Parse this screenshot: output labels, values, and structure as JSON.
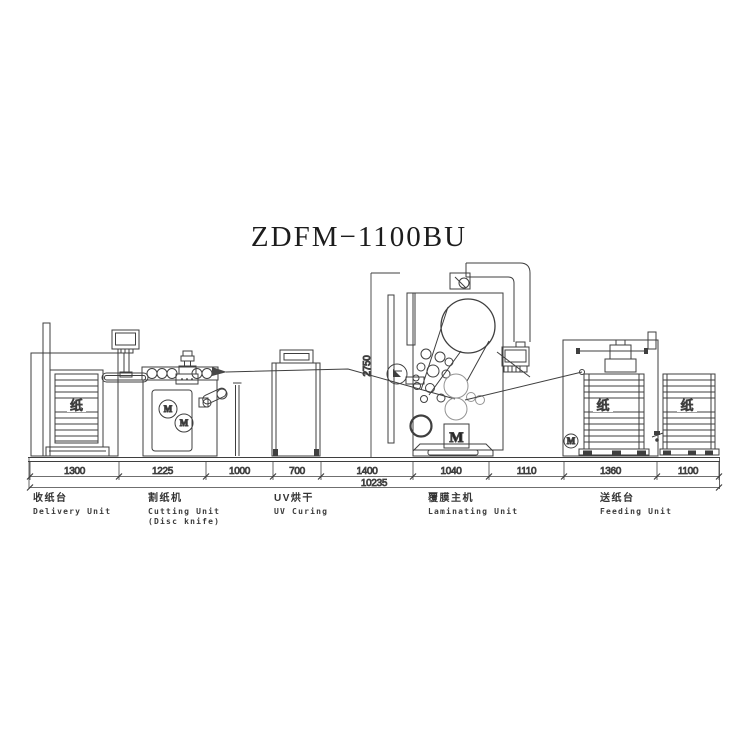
{
  "title": "ZDFM−1100BU",
  "dimensions": {
    "segments": [
      "1300",
      "1225",
      "1000",
      "700",
      "1400",
      "1040",
      "1110",
      "1360",
      "1100"
    ],
    "total": "10235",
    "machine_height": "2750"
  },
  "unit_labels": [
    {
      "zh": "收纸台",
      "en": "Delivery Unit",
      "en2": ""
    },
    {
      "zh": "割纸机",
      "en": "Cutting Unit",
      "en2": "(Disc knife)"
    },
    {
      "zh": "UV烘干",
      "en": "UV Curing",
      "en2": ""
    },
    {
      "zh": "覆膜主机",
      "en": "Laminating Unit",
      "en2": ""
    },
    {
      "zh": "送纸台",
      "en": "Feeding Unit",
      "en2": ""
    }
  ],
  "glyphs": {
    "paper": "纸",
    "motor": "M"
  },
  "colors": {
    "line": "#3f3f3f",
    "light_line": "#949494",
    "background": "#ffffff"
  }
}
